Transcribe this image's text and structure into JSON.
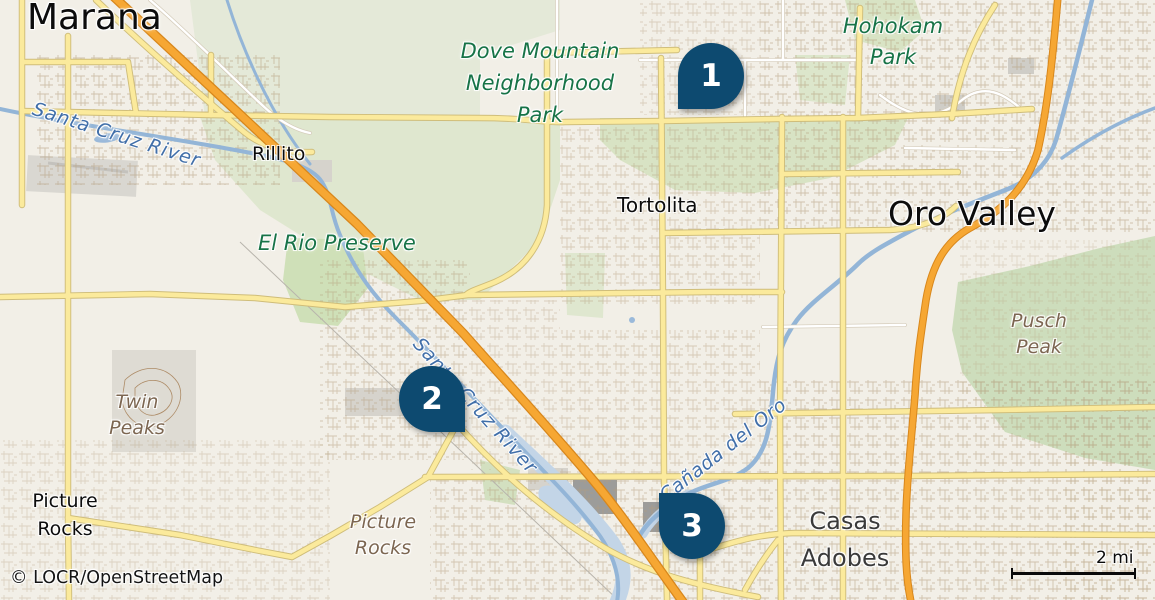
{
  "map": {
    "attribution": "© LOCR/OpenStreetMap",
    "scale": {
      "label": "2 mi"
    },
    "colors": {
      "marker": "#0d4a70",
      "marker_text": "#ffffff",
      "park_label": "#177347",
      "peak_label": "#7c6651",
      "water_label": "#416fa9",
      "highway_orange": "#f6a733",
      "road_yellow": "#fbea9c",
      "river_blue": "#93b5d7",
      "background": "#f2efe7"
    },
    "markers": [
      {
        "number": "1"
      },
      {
        "number": "2"
      },
      {
        "number": "3"
      }
    ],
    "labels": {
      "cities": {
        "marana": "Marana",
        "oro_valley": "Oro Valley",
        "rillito": "Rillito",
        "tortolita": "Tortolita",
        "picture_rocks": [
          "Picture",
          "Rocks"
        ],
        "casas_adobes": [
          "Casas",
          "Adobes"
        ]
      },
      "parks": {
        "dove_mountain": [
          "Dove Mountain",
          "Neighborhood",
          "Park"
        ],
        "hohokam": [
          "Hohokam",
          "Park"
        ],
        "el_rio": "El Rio Preserve"
      },
      "peaks": {
        "twin_peaks": [
          "Twin",
          "Peaks"
        ],
        "pusch_peak": [
          "Pusch",
          "Peak"
        ],
        "picture_rocks_wash": [
          "Picture",
          "Rocks"
        ]
      },
      "waterways": {
        "santa_cruz_nw": "Santa Cruz River",
        "santa_cruz_c": "Santa Cruz River",
        "canada_del_oro": "Cañada del Oro"
      }
    }
  }
}
